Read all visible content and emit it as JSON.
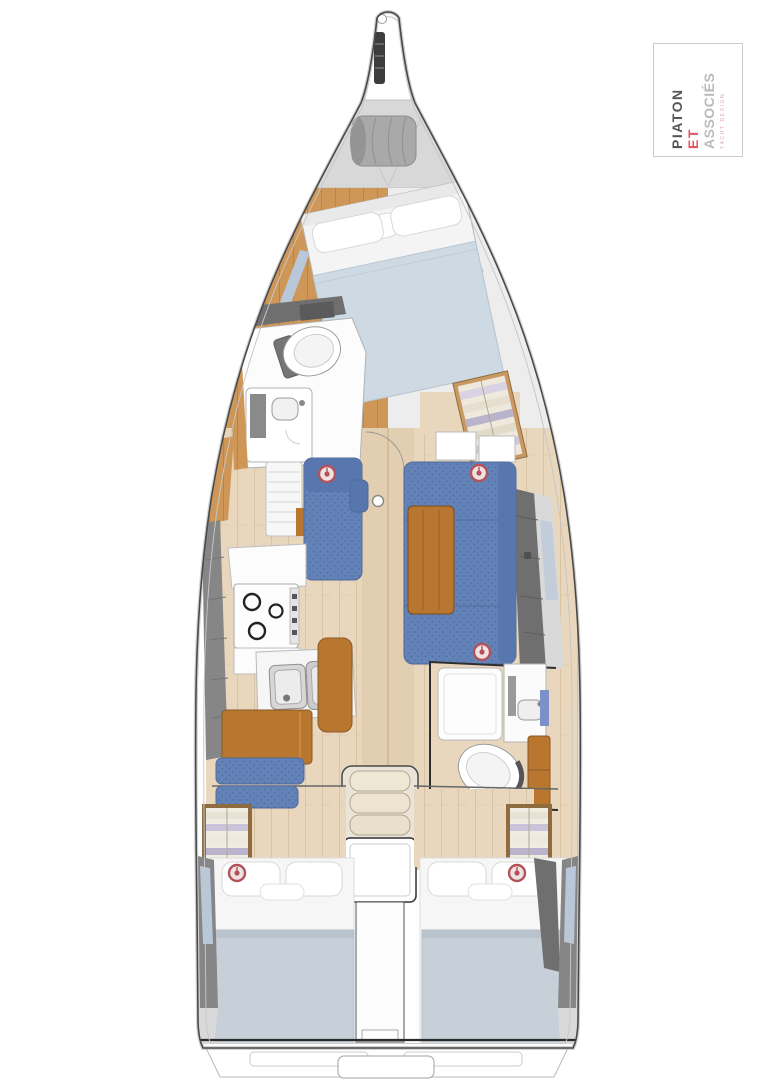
{
  "logo": {
    "line1": "PIATON",
    "line2": "ET",
    "line3": "ASSOCIÉS",
    "tagline": "YACHT DESIGN"
  },
  "palette": {
    "hull_line": "#4a4a4a",
    "deck_gray": "#868686",
    "deck_dark": "#6f6f6f",
    "locker_gray": "#d8d8d8",
    "wood_warm": "#cf9757",
    "wood_table": "#b8762f",
    "wood_floor": "#e9d7bd",
    "upholstery_blue": "#6282b8",
    "bed_blue": "#cdd9e3",
    "mattress_blue": "#c7d0d8",
    "window_blue": "#b9c7da",
    "marker_red": "#b4525a",
    "fixture_white": "#fcfcfc",
    "logo_line1": "#55565a",
    "logo_line2": "#e4555f",
    "logo_line3": "#b9babc",
    "logo_tagline": "#e0a9ad"
  }
}
